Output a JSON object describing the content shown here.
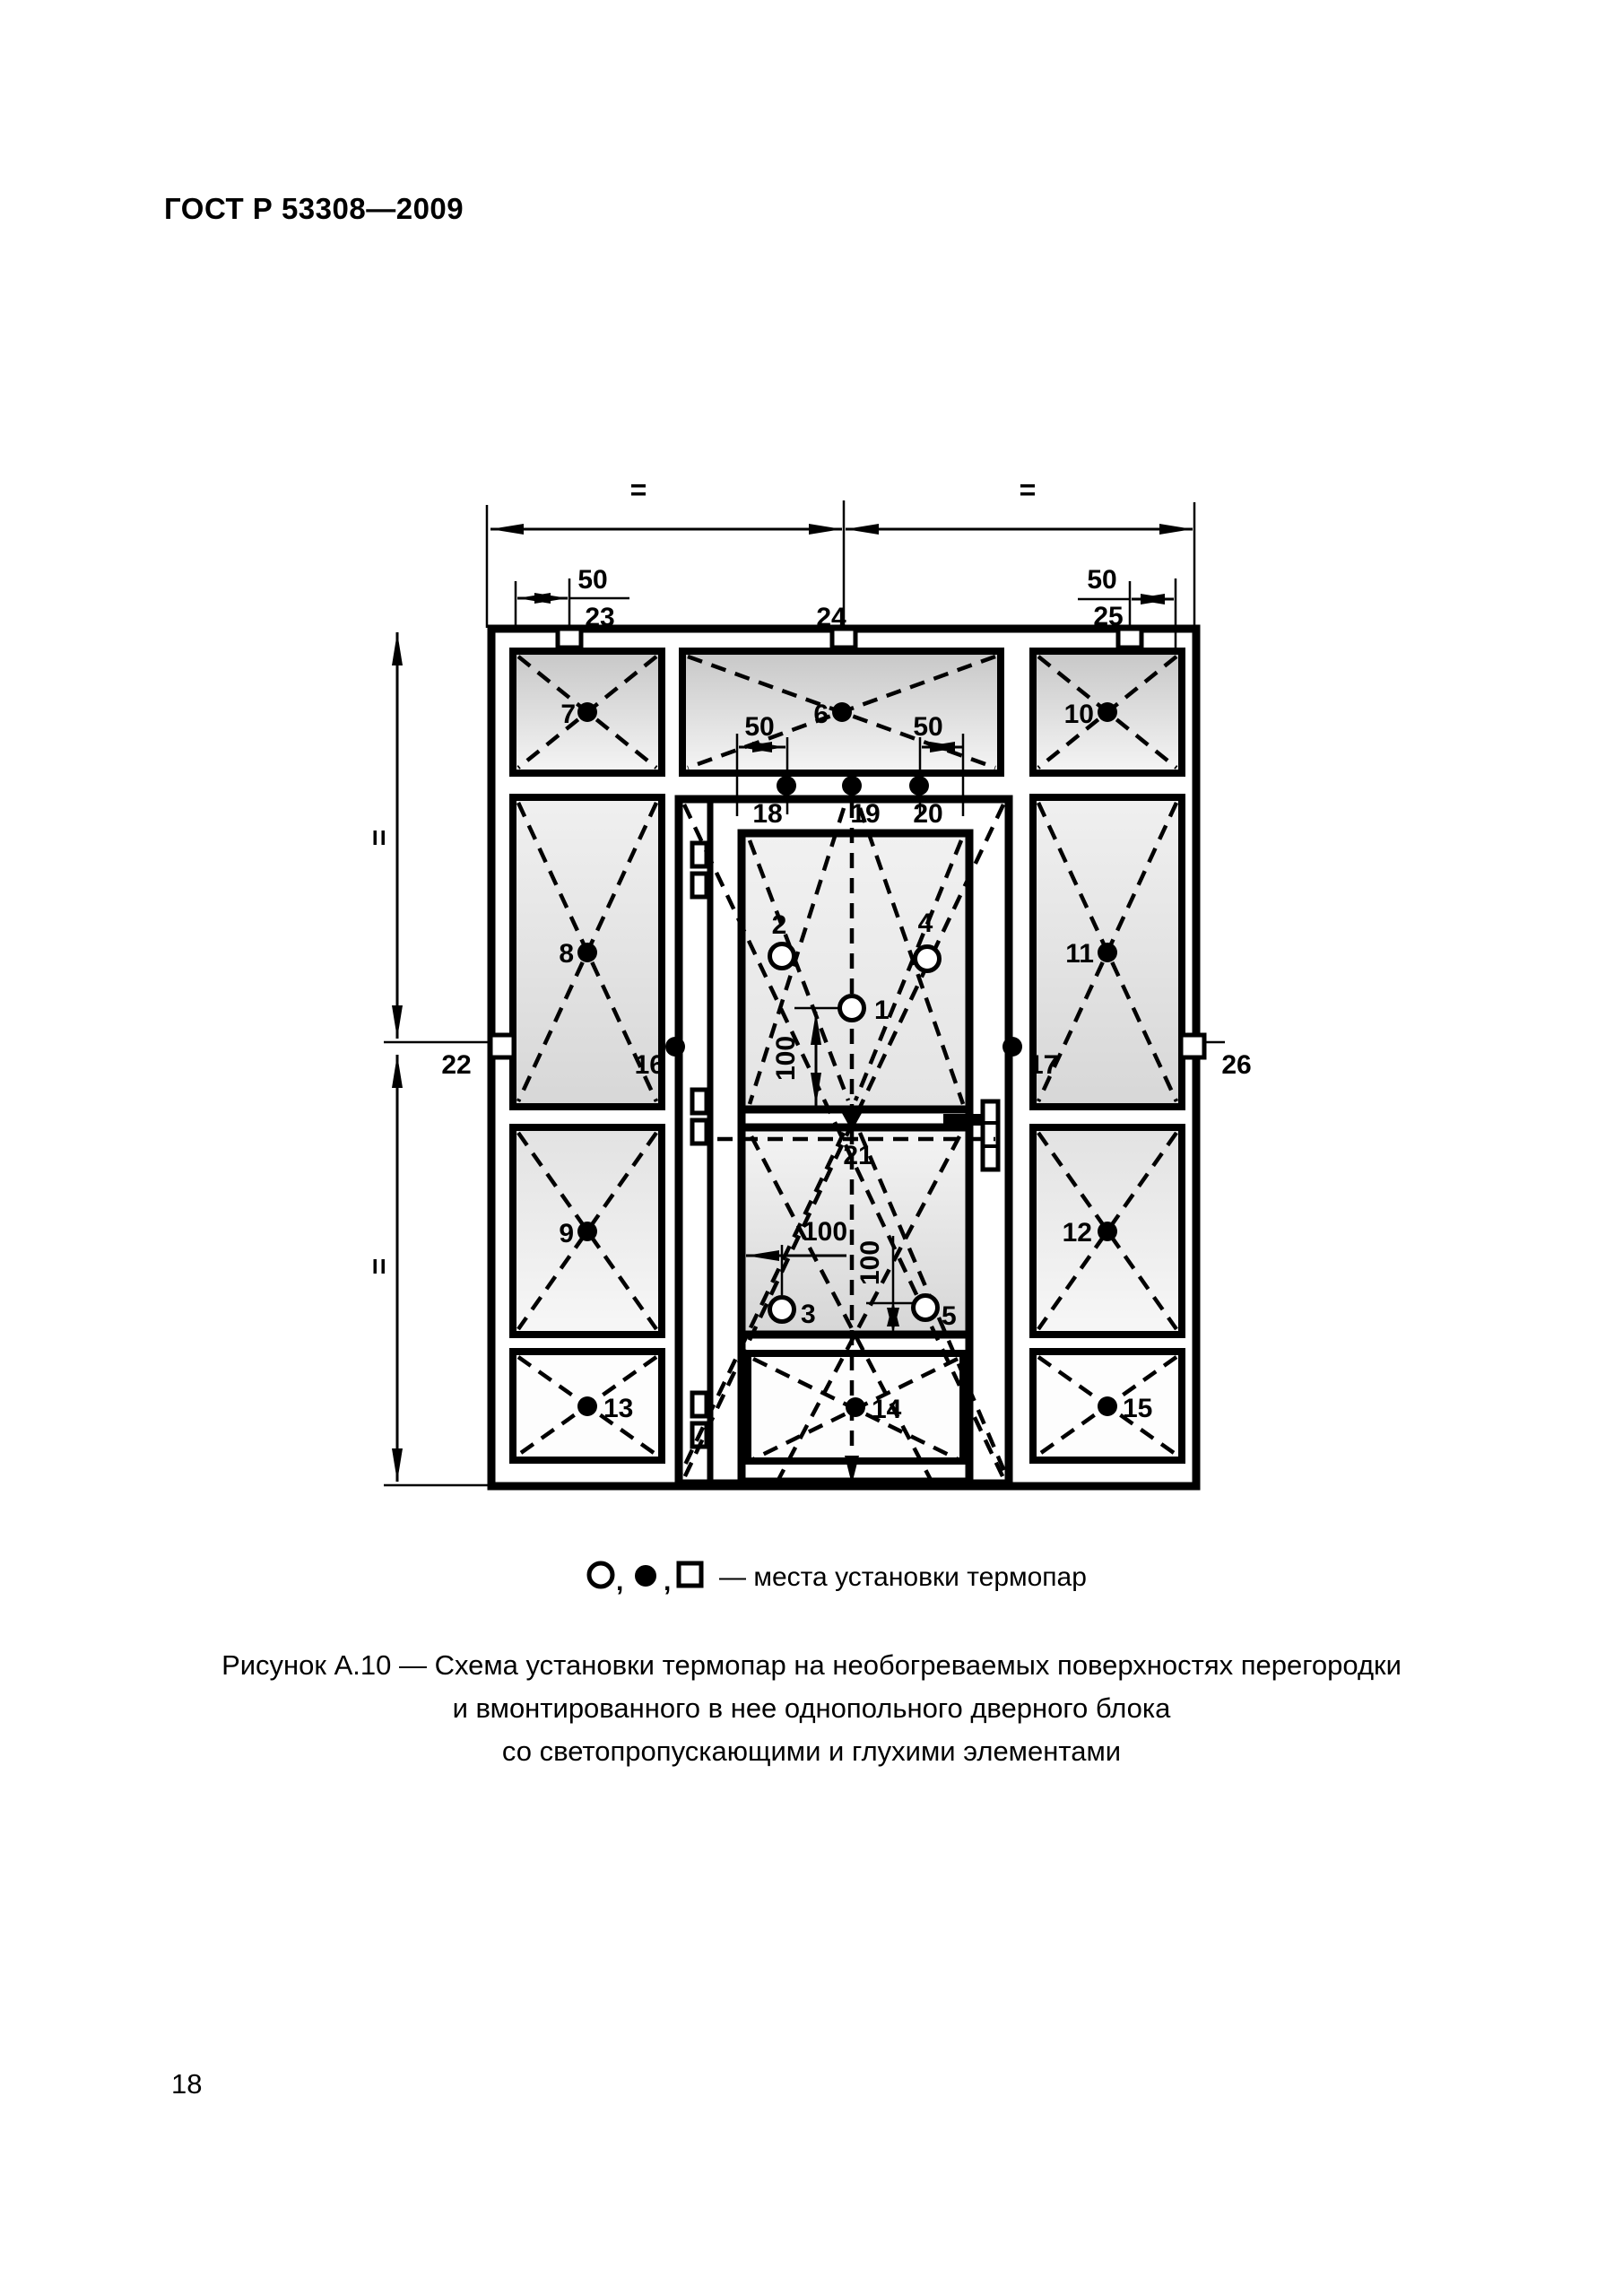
{
  "page": {
    "header": "ГОСТ Р 53308—2009",
    "number": "18"
  },
  "figure_caption": {
    "line1": "Рисунок А.10 — Схема установки термопар на необогреваемых поверхностях перегородки",
    "line2": "и вмонтированного в нее однопольного дверного блока",
    "line3": "со светопропускающими и глухими элементами"
  },
  "legend": {
    "symbols": [
      "open-circle",
      "filled-circle",
      "open-square"
    ],
    "comma": ",",
    "text": "— места установки термопар"
  },
  "dims": {
    "d50": "50",
    "d100": "100",
    "equal": "="
  },
  "labels": {
    "1": "1",
    "2": "2",
    "3": "3",
    "4": "4",
    "5": "5",
    "6": "6",
    "7": "7",
    "8": "8",
    "9": "9",
    "10": "10",
    "11": "11",
    "12": "12",
    "13": "13",
    "14": "14",
    "15": "15",
    "16": "16",
    "17": "17",
    "18": "18",
    "19": "19",
    "20": "20",
    "21": "21",
    "22": "22",
    "23": "23",
    "24": "24",
    "25": "25",
    "26": "26"
  },
  "colors": {
    "line": "#000000",
    "panel_dark": "#c9c9c9",
    "panel_light": "#f5f5f5"
  }
}
